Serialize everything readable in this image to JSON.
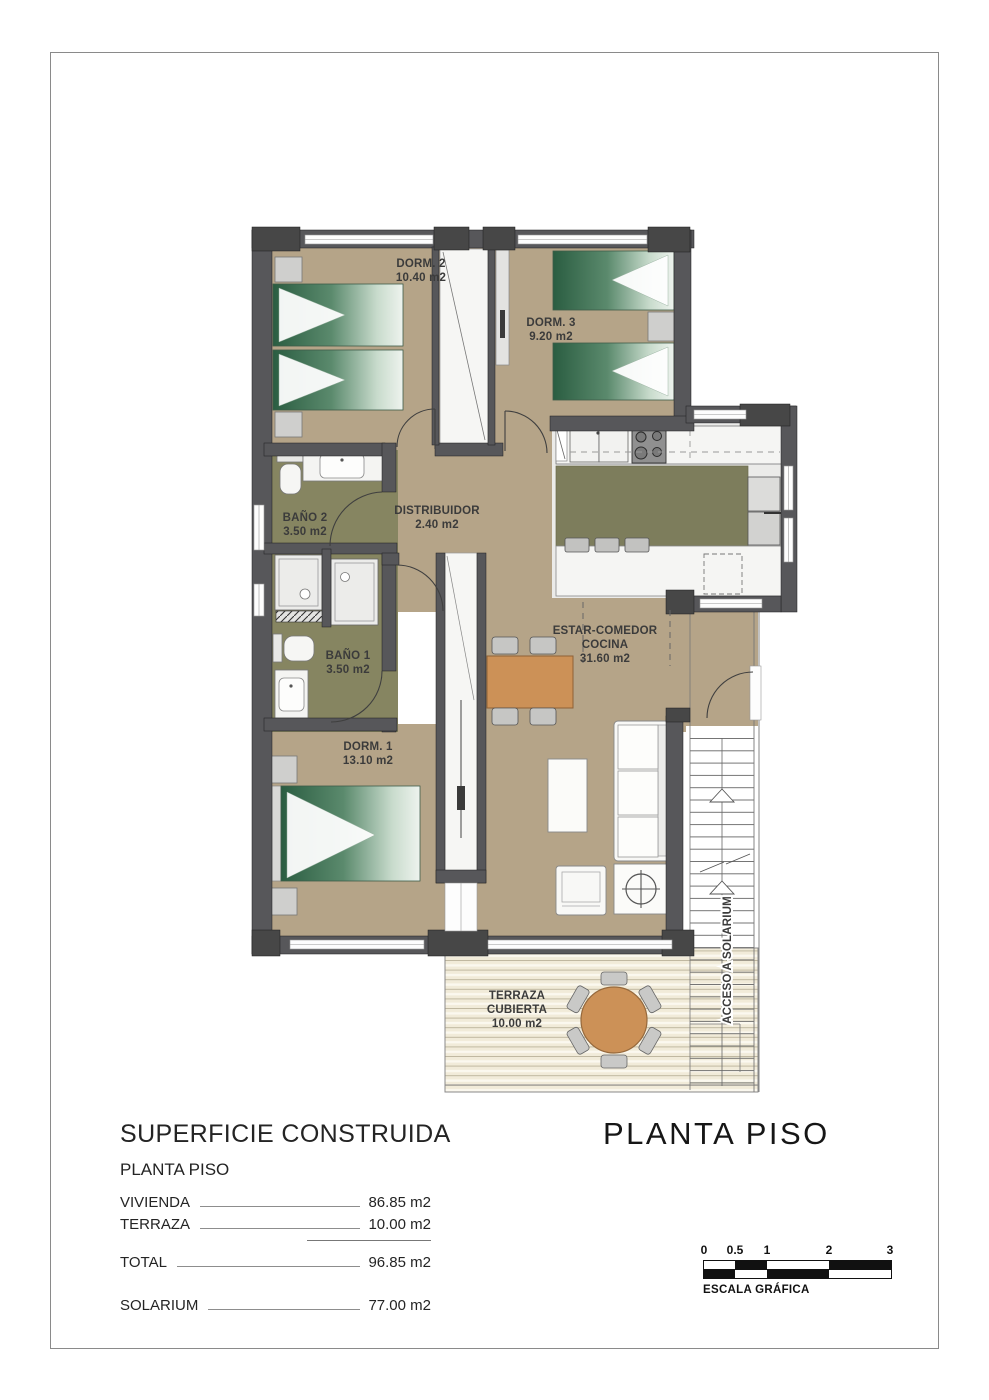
{
  "plan": {
    "rooms": {
      "dorm2": {
        "name": "DORM. 2",
        "area": "10.40 m2"
      },
      "dorm3": {
        "name": "DORM. 3",
        "area": "9.20 m2"
      },
      "bano2": {
        "name": "BAÑO 2",
        "area": "3.50 m2"
      },
      "distribuidor": {
        "name": "DISTRIBUIDOR",
        "area": "2.40 m2"
      },
      "bano1": {
        "name": "BAÑO 1",
        "area": "3.50 m2"
      },
      "dorm1": {
        "name": "DORM. 1",
        "area": "13.10 m2"
      },
      "estar": {
        "name": "ESTAR-COMEDOR",
        "name2": "COCINA",
        "area": "31.60 m2"
      },
      "terraza": {
        "name": "TERRAZA",
        "name2": "CUBIERTA",
        "area": "10.00 m2"
      }
    },
    "stairs": {
      "label": "ACCESO A SOLARIUM"
    }
  },
  "summary": {
    "title": "SUPERFICIE CONSTRUIDA",
    "subtitle": "PLANTA PISO",
    "rows": [
      {
        "label": "VIVIENDA",
        "value": "86.85 m2"
      },
      {
        "label": "TERRAZA",
        "value": "10.00 m2"
      },
      {
        "label": "TOTAL",
        "value": "96.85 m2"
      },
      {
        "label": "SOLARIUM",
        "value": "77.00 m2"
      }
    ]
  },
  "title_block": {
    "title": "PLANTA PISO"
  },
  "scale_bar": {
    "ticks": [
      "0",
      "0.5",
      "1",
      "2",
      "3"
    ],
    "caption": "ESCALA GRÁFICA"
  },
  "colors": {
    "floor_tan": "#b5a488",
    "bathroom_olive": "#868561",
    "island_olive": "#7d7d5c",
    "wall_gray": "#57575a",
    "bed_green": "#2a5d41",
    "table_orange": "#cc9157",
    "terrace_cream": "#f1ebd9"
  }
}
